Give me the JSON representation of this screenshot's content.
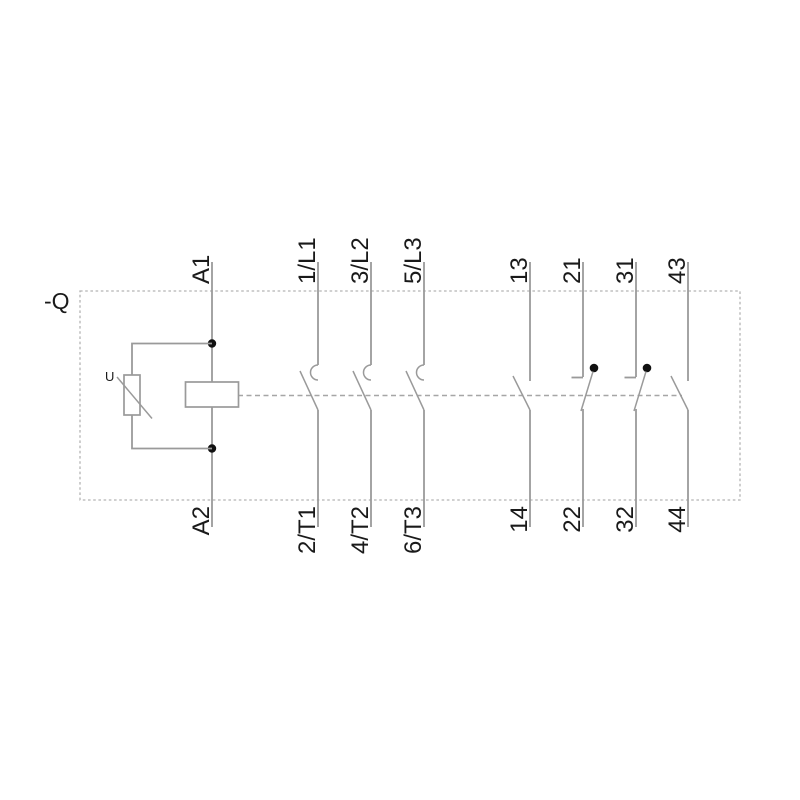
{
  "device": {
    "ref_label": "-Q"
  },
  "coil": {
    "top_terminal": "A1",
    "bottom_terminal": "A2",
    "suppressor_label": "U"
  },
  "poles": [
    {
      "top": "1/L1",
      "bottom": "2/T1"
    },
    {
      "top": "3/L2",
      "bottom": "4/T2"
    },
    {
      "top": "5/L3",
      "bottom": "6/T3"
    }
  ],
  "aux": [
    {
      "top": "13",
      "bottom": "14",
      "type": "NO"
    },
    {
      "top": "21",
      "bottom": "22",
      "type": "NC"
    },
    {
      "top": "31",
      "bottom": "32",
      "type": "NC"
    },
    {
      "top": "43",
      "bottom": "44",
      "type": "NO"
    }
  ],
  "colors": {
    "line": "#9a9a9a",
    "border": "#b4b4b4",
    "linkage": "#a6a6a6",
    "text": "#1a1a1a",
    "dot": "#111111",
    "background": "#ffffff"
  }
}
